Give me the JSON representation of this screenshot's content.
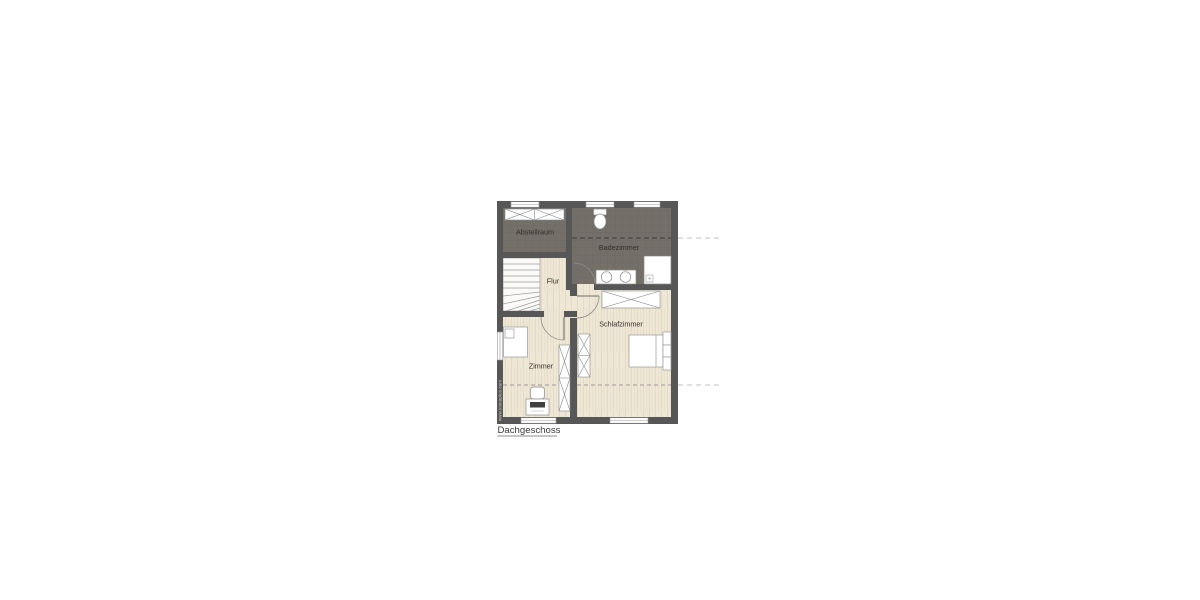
{
  "title": {
    "label": "Dachgeschoss"
  },
  "watermark": {
    "label": "www.immoplus.com"
  },
  "rooms": {
    "abstellraum": {
      "label": "Abstellraum"
    },
    "badezimmer": {
      "label": "Badezimmer"
    },
    "flur": {
      "label": "Flur"
    },
    "schlafzimmer": {
      "label": "Schlafzimmer"
    },
    "zimmer": {
      "label": "Zimmer"
    }
  },
  "colors": {
    "wall": "#575757",
    "tile_floor": "#747069",
    "tile_grid": "#6b6761",
    "wood_floor": "#efe7d5",
    "furniture_outline": "#8a8a8a",
    "knee_line_dark": "#3d3d3d",
    "knee_line_wood": "#9b9b9b",
    "knee_line_outside": "#cdcdcd",
    "label_text": "#33302c"
  }
}
